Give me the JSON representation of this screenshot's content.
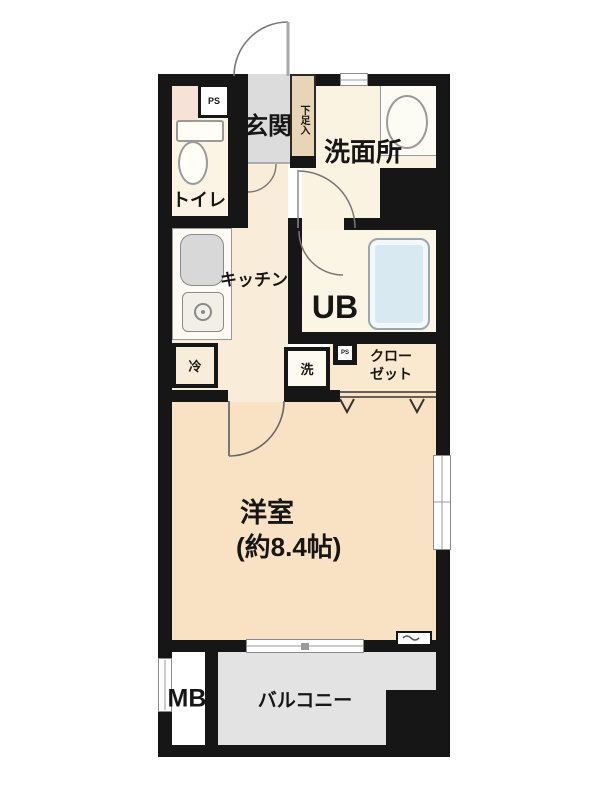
{
  "plan": {
    "rooms": {
      "entrance": {
        "label": "玄関"
      },
      "shoe_cabinet": {
        "label": "下足入"
      },
      "washroom": {
        "label": "洗面所"
      },
      "toilet": {
        "label": "トイレ"
      },
      "kitchen": {
        "label": "キッチン"
      },
      "unit_bath": {
        "label": "UB"
      },
      "closet": {
        "line1": "クロー",
        "line2": "ゼット"
      },
      "western_room": {
        "label": "洋室",
        "size": "(約8.4帖)"
      },
      "meter_box": {
        "label": "MB"
      },
      "balcony": {
        "label": "バルコニー"
      }
    },
    "fixtures": {
      "pipe_space_toilet": {
        "label": "PS"
      },
      "pipe_space_closet": {
        "label": "PS"
      },
      "refrigerator_space": {
        "label": "冷"
      },
      "washer_space": {
        "label": "洗"
      }
    },
    "colors": {
      "wall": "#161616",
      "western_room_floor": "#f9e2c3",
      "kitchen_floor": "#f9edd9",
      "entrance_floor": "#dcdcdc",
      "shoe_cabinet": "#e8d5b5",
      "washroom_floor": "#fbf3e1",
      "toilet_floor": "#fbf3e3",
      "toilet_accent": "#f6e2d6",
      "unit_bath_floor": "#fbf5e6",
      "bathtub": "#d8e9f1",
      "closet_floor": "#f9e9cf",
      "balcony_floor": "#e3e3e3"
    }
  }
}
